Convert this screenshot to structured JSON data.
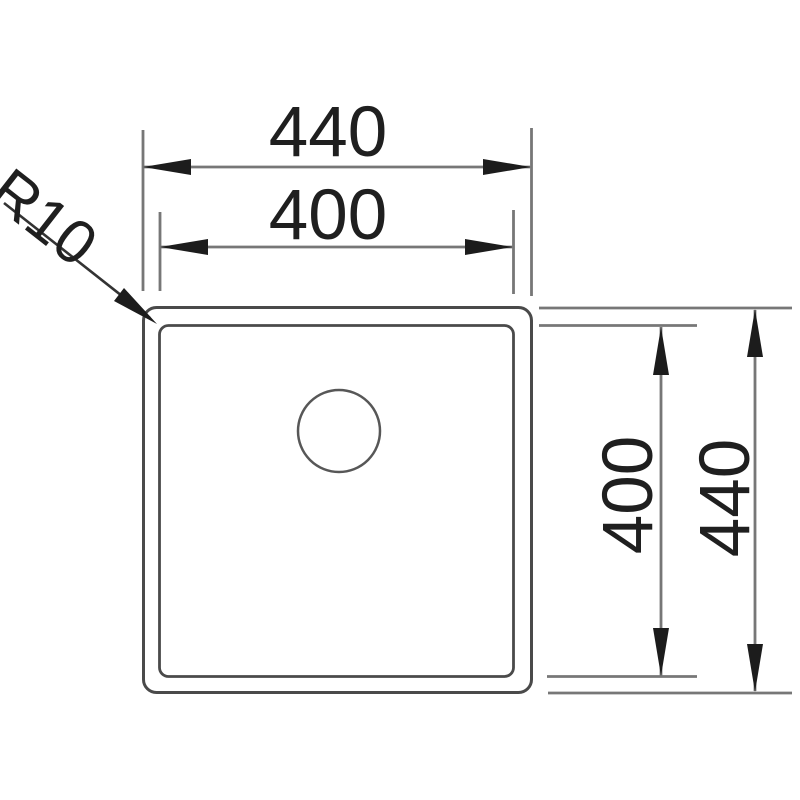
{
  "diagram": {
    "labels": {
      "outer_width": "440",
      "inner_width": "400",
      "inner_height": "400",
      "outer_height": "440",
      "corner_radius": "R10"
    },
    "colors": {
      "background": "#ffffff",
      "outline": "#4a4a4a",
      "drain": "#575757",
      "dimension_line": "#777777",
      "leader_line": "#333333",
      "arrow": "#1c1c1c",
      "text": "#1f1f1f"
    }
  }
}
